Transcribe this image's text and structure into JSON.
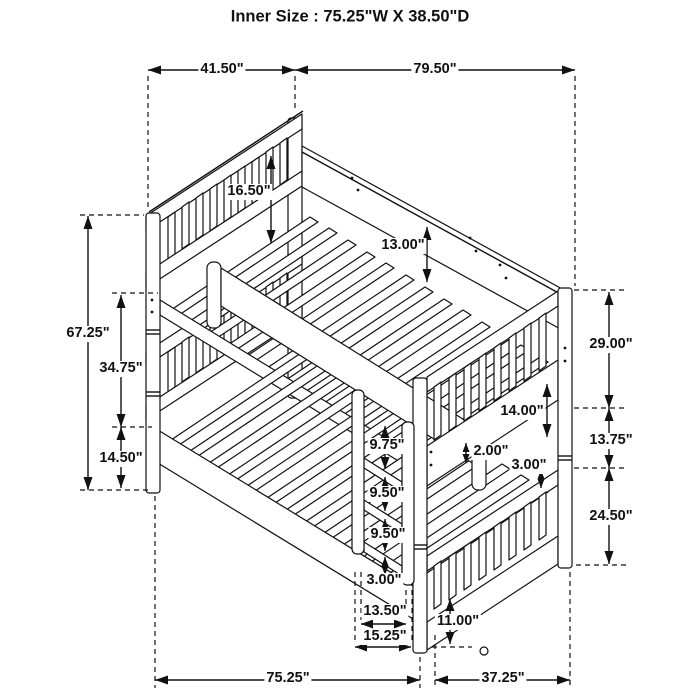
{
  "title": "Inner Size : 75.25\"W X  38.50\"D",
  "dims": {
    "top_width": "41.50\"",
    "top_length": "79.50\"",
    "height_total": "67.25\"",
    "left_mid": "34.75\"",
    "left_lower": "14.50\"",
    "headboard_guard": "16.50\"",
    "foot_panel": "13.00\"",
    "right_upper": "29.00\"",
    "right_mid": "13.75\"",
    "right_lower": "24.50\"",
    "guard_to_rail": "14.00\"",
    "slat_thickness": "2.00\"",
    "rail_thickness": "3.00\"",
    "ladder_step_top": "9.75\"",
    "ladder_step_mid": "9.50\"",
    "ladder_step_low": "9.50\"",
    "ladder_step_bottom": "3.00\"",
    "ladder_width_inner": "13.50\"",
    "ladder_width_outer": "15.25\"",
    "under_bed_clearance": "11.00\"",
    "bottom_length": "75.25\"",
    "bottom_depth": "37.25\""
  }
}
